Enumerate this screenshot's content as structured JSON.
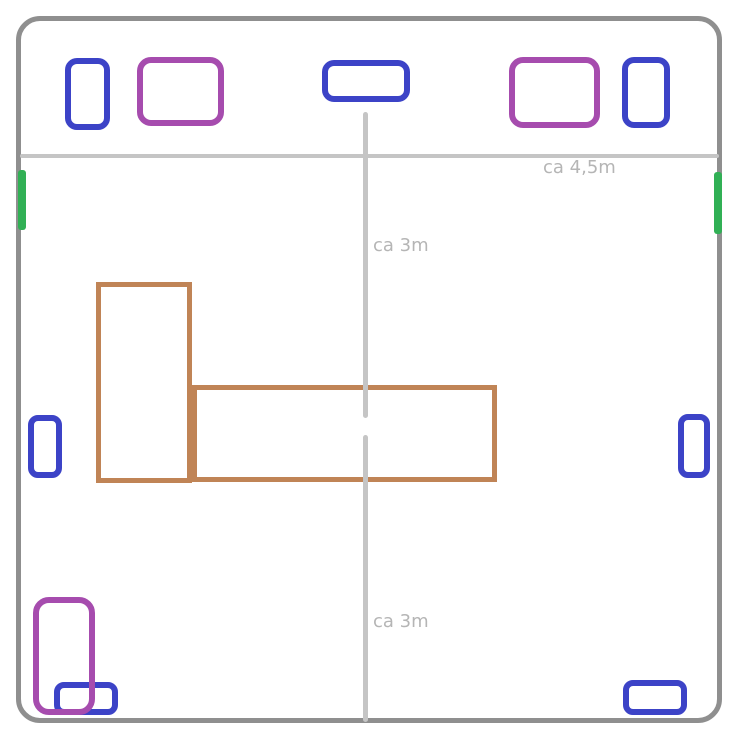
{
  "diagram": {
    "title": "room-floor-plan-sketch",
    "canvas": {
      "width": 750,
      "height": 755
    },
    "colors": {
      "border": "#8f8f8f",
      "guide": "#c5c5c5",
      "label_text": "#b5b5b5",
      "blue": "#3c43c7",
      "purple": "#a64cae",
      "green": "#31b055",
      "brown": "#c08456",
      "background": "#ffffff"
    },
    "labels": [
      {
        "name": "label-room-width",
        "text": "ca 4,5m",
        "x": 543,
        "y": 158
      },
      {
        "name": "label-room-depth-top",
        "text": "ca 3m",
        "x": 373,
        "y": 236
      },
      {
        "name": "label-room-depth-bottom",
        "text": "ca 3m",
        "x": 373,
        "y": 612
      }
    ],
    "shapes": [
      {
        "name": "room-outline",
        "type": "outline",
        "color": "border",
        "x": 16,
        "y": 16,
        "w": 706,
        "h": 707,
        "stroke": 5,
        "radius": 24
      },
      {
        "name": "top-wall-divider-line",
        "type": "bar",
        "color": "guide",
        "x": 20,
        "y": 154,
        "w": 699,
        "h": 4,
        "radius": 2
      },
      {
        "name": "blue-cabinet-top-left",
        "type": "outline",
        "color": "blue",
        "x": 65,
        "y": 58,
        "w": 45,
        "h": 72,
        "stroke": 6,
        "radius": 12
      },
      {
        "name": "purple-cabinet-top-left",
        "type": "outline",
        "color": "purple",
        "x": 137,
        "y": 57,
        "w": 87,
        "h": 69,
        "stroke": 6,
        "radius": 14
      },
      {
        "name": "blue-cabinet-top-center",
        "type": "outline",
        "color": "blue",
        "x": 322,
        "y": 60,
        "w": 88,
        "h": 42,
        "stroke": 6,
        "radius": 12
      },
      {
        "name": "purple-cabinet-top-right",
        "type": "outline",
        "color": "purple",
        "x": 509,
        "y": 57,
        "w": 91,
        "h": 71,
        "stroke": 6,
        "radius": 14
      },
      {
        "name": "blue-cabinet-top-right",
        "type": "outline",
        "color": "blue",
        "x": 622,
        "y": 57,
        "w": 48,
        "h": 71,
        "stroke": 6,
        "radius": 12
      },
      {
        "name": "green-wall-marker-left",
        "type": "bar",
        "color": "green",
        "x": 18,
        "y": 170,
        "w": 8,
        "h": 60,
        "radius": 3
      },
      {
        "name": "green-wall-marker-right",
        "type": "bar",
        "color": "green",
        "x": 714,
        "y": 172,
        "w": 8,
        "h": 62,
        "radius": 3
      },
      {
        "name": "brown-table-left-section",
        "type": "outline",
        "color": "brown",
        "x": 96,
        "y": 282,
        "w": 96,
        "h": 201,
        "stroke": 5,
        "radius": 0
      },
      {
        "name": "brown-table-right-section",
        "type": "outline",
        "color": "brown",
        "x": 192,
        "y": 385,
        "w": 305,
        "h": 97,
        "stroke": 5,
        "radius": 0
      },
      {
        "name": "vertical-guide-top",
        "type": "bar",
        "color": "guide",
        "x": 363,
        "y": 112,
        "w": 5,
        "h": 306,
        "radius": 3
      },
      {
        "name": "vertical-guide-bottom",
        "type": "bar",
        "color": "guide",
        "x": 363,
        "y": 435,
        "w": 5,
        "h": 287,
        "radius": 3
      },
      {
        "name": "blue-unit-mid-left",
        "type": "outline",
        "color": "blue",
        "x": 28,
        "y": 415,
        "w": 34,
        "h": 63,
        "stroke": 6,
        "radius": 10
      },
      {
        "name": "blue-unit-mid-right",
        "type": "outline",
        "color": "blue",
        "x": 678,
        "y": 414,
        "w": 32,
        "h": 64,
        "stroke": 6,
        "radius": 10
      },
      {
        "name": "blue-unit-bottom-left",
        "type": "outline",
        "color": "blue",
        "x": 54,
        "y": 682,
        "w": 64,
        "h": 33,
        "stroke": 6,
        "radius": 10
      },
      {
        "name": "purple-unit-bottom-left",
        "type": "outline",
        "color": "purple",
        "x": 33,
        "y": 597,
        "w": 62,
        "h": 118,
        "stroke": 6,
        "radius": 16
      },
      {
        "name": "blue-unit-bottom-right",
        "type": "outline",
        "color": "blue",
        "x": 623,
        "y": 680,
        "w": 64,
        "h": 35,
        "stroke": 6,
        "radius": 10
      }
    ]
  }
}
